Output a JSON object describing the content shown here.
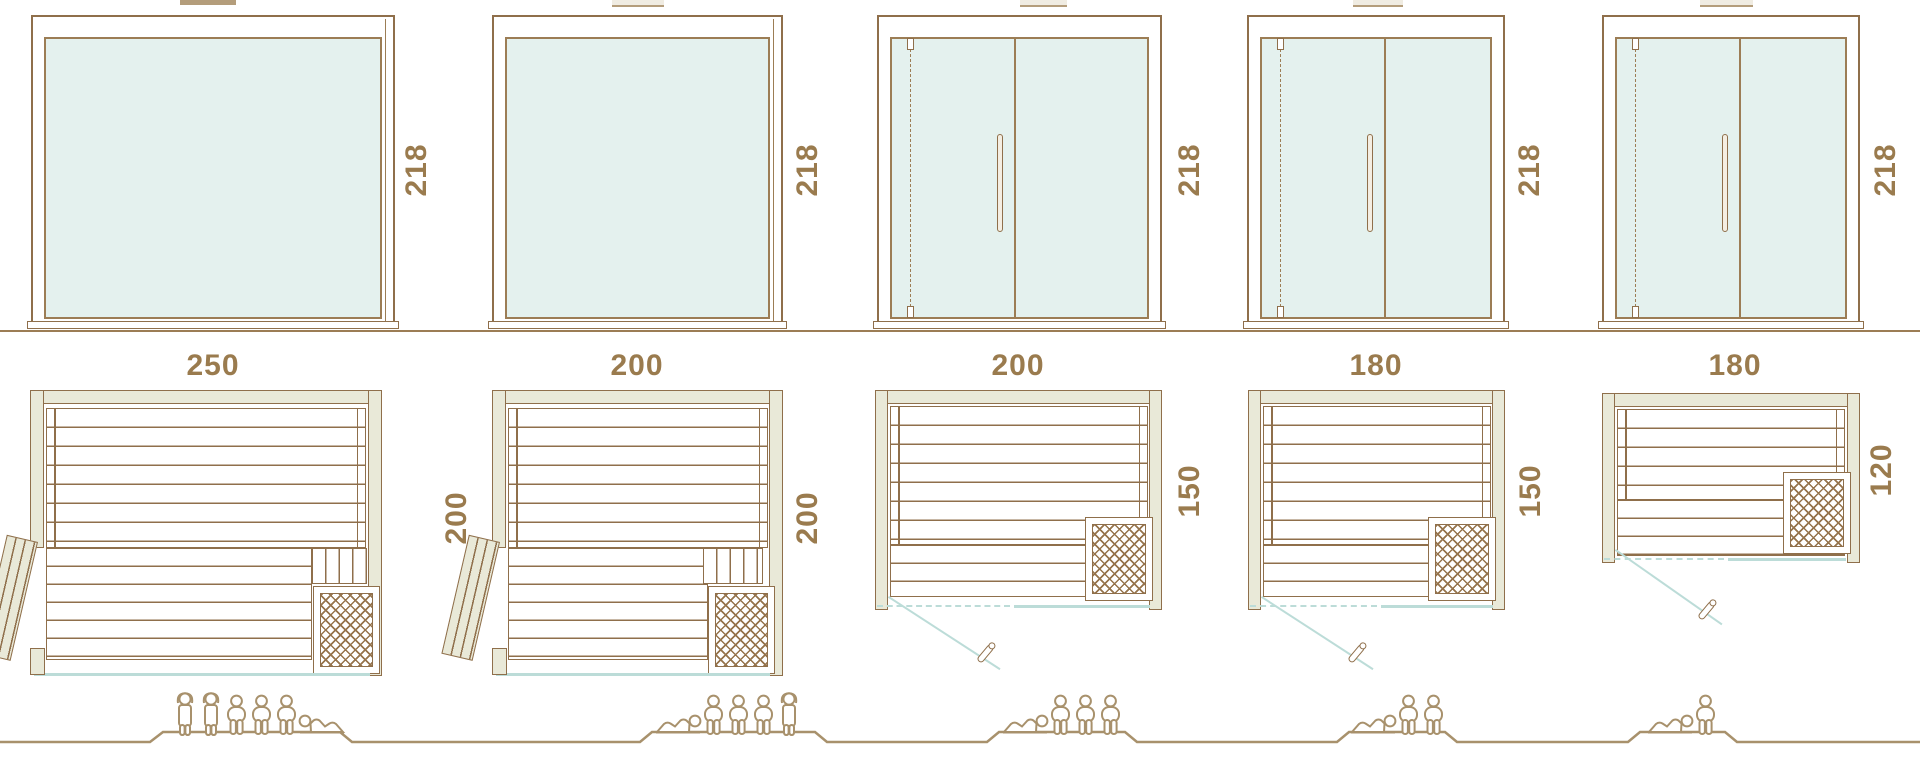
{
  "palette": {
    "line": "#8f6f4b",
    "wall_fill": "#e9e9d8",
    "glass_fill": "#e4f1ee",
    "glass_blue": "#bcdcd8",
    "label_text": "#9a7b4e",
    "people": "#a8916c"
  },
  "models": [
    {
      "height_label": "218",
      "width_label": "250",
      "depth_label": "200",
      "front": "fixed-glass-panel",
      "plan_door": "hinged-door-open-left",
      "occupants": [
        "standing",
        "standing",
        "sitting",
        "sitting",
        "sitting",
        "lying"
      ]
    },
    {
      "height_label": "218",
      "width_label": "200",
      "depth_label": "200",
      "front": "fixed-glass-panel",
      "plan_door": "hinged-door-open-left",
      "occupants": [
        "lying",
        "sitting",
        "sitting",
        "sitting",
        "standing"
      ]
    },
    {
      "height_label": "218",
      "width_label": "200",
      "depth_label": "150",
      "front": "glass-door-left-fixed-panel-right",
      "plan_door": "glass-door-swing-out",
      "occupants": [
        "lying",
        "sitting",
        "sitting",
        "sitting"
      ]
    },
    {
      "height_label": "218",
      "width_label": "180",
      "depth_label": "150",
      "front": "glass-door-left-fixed-panel-right",
      "plan_door": "glass-door-swing-out",
      "occupants": [
        "lying",
        "sitting",
        "sitting"
      ]
    },
    {
      "height_label": "218",
      "width_label": "180",
      "depth_label": "120",
      "front": "glass-door-left-fixed-panel-right",
      "plan_door": "glass-door-swing-out",
      "occupants": [
        "lying",
        "sitting"
      ]
    }
  ]
}
